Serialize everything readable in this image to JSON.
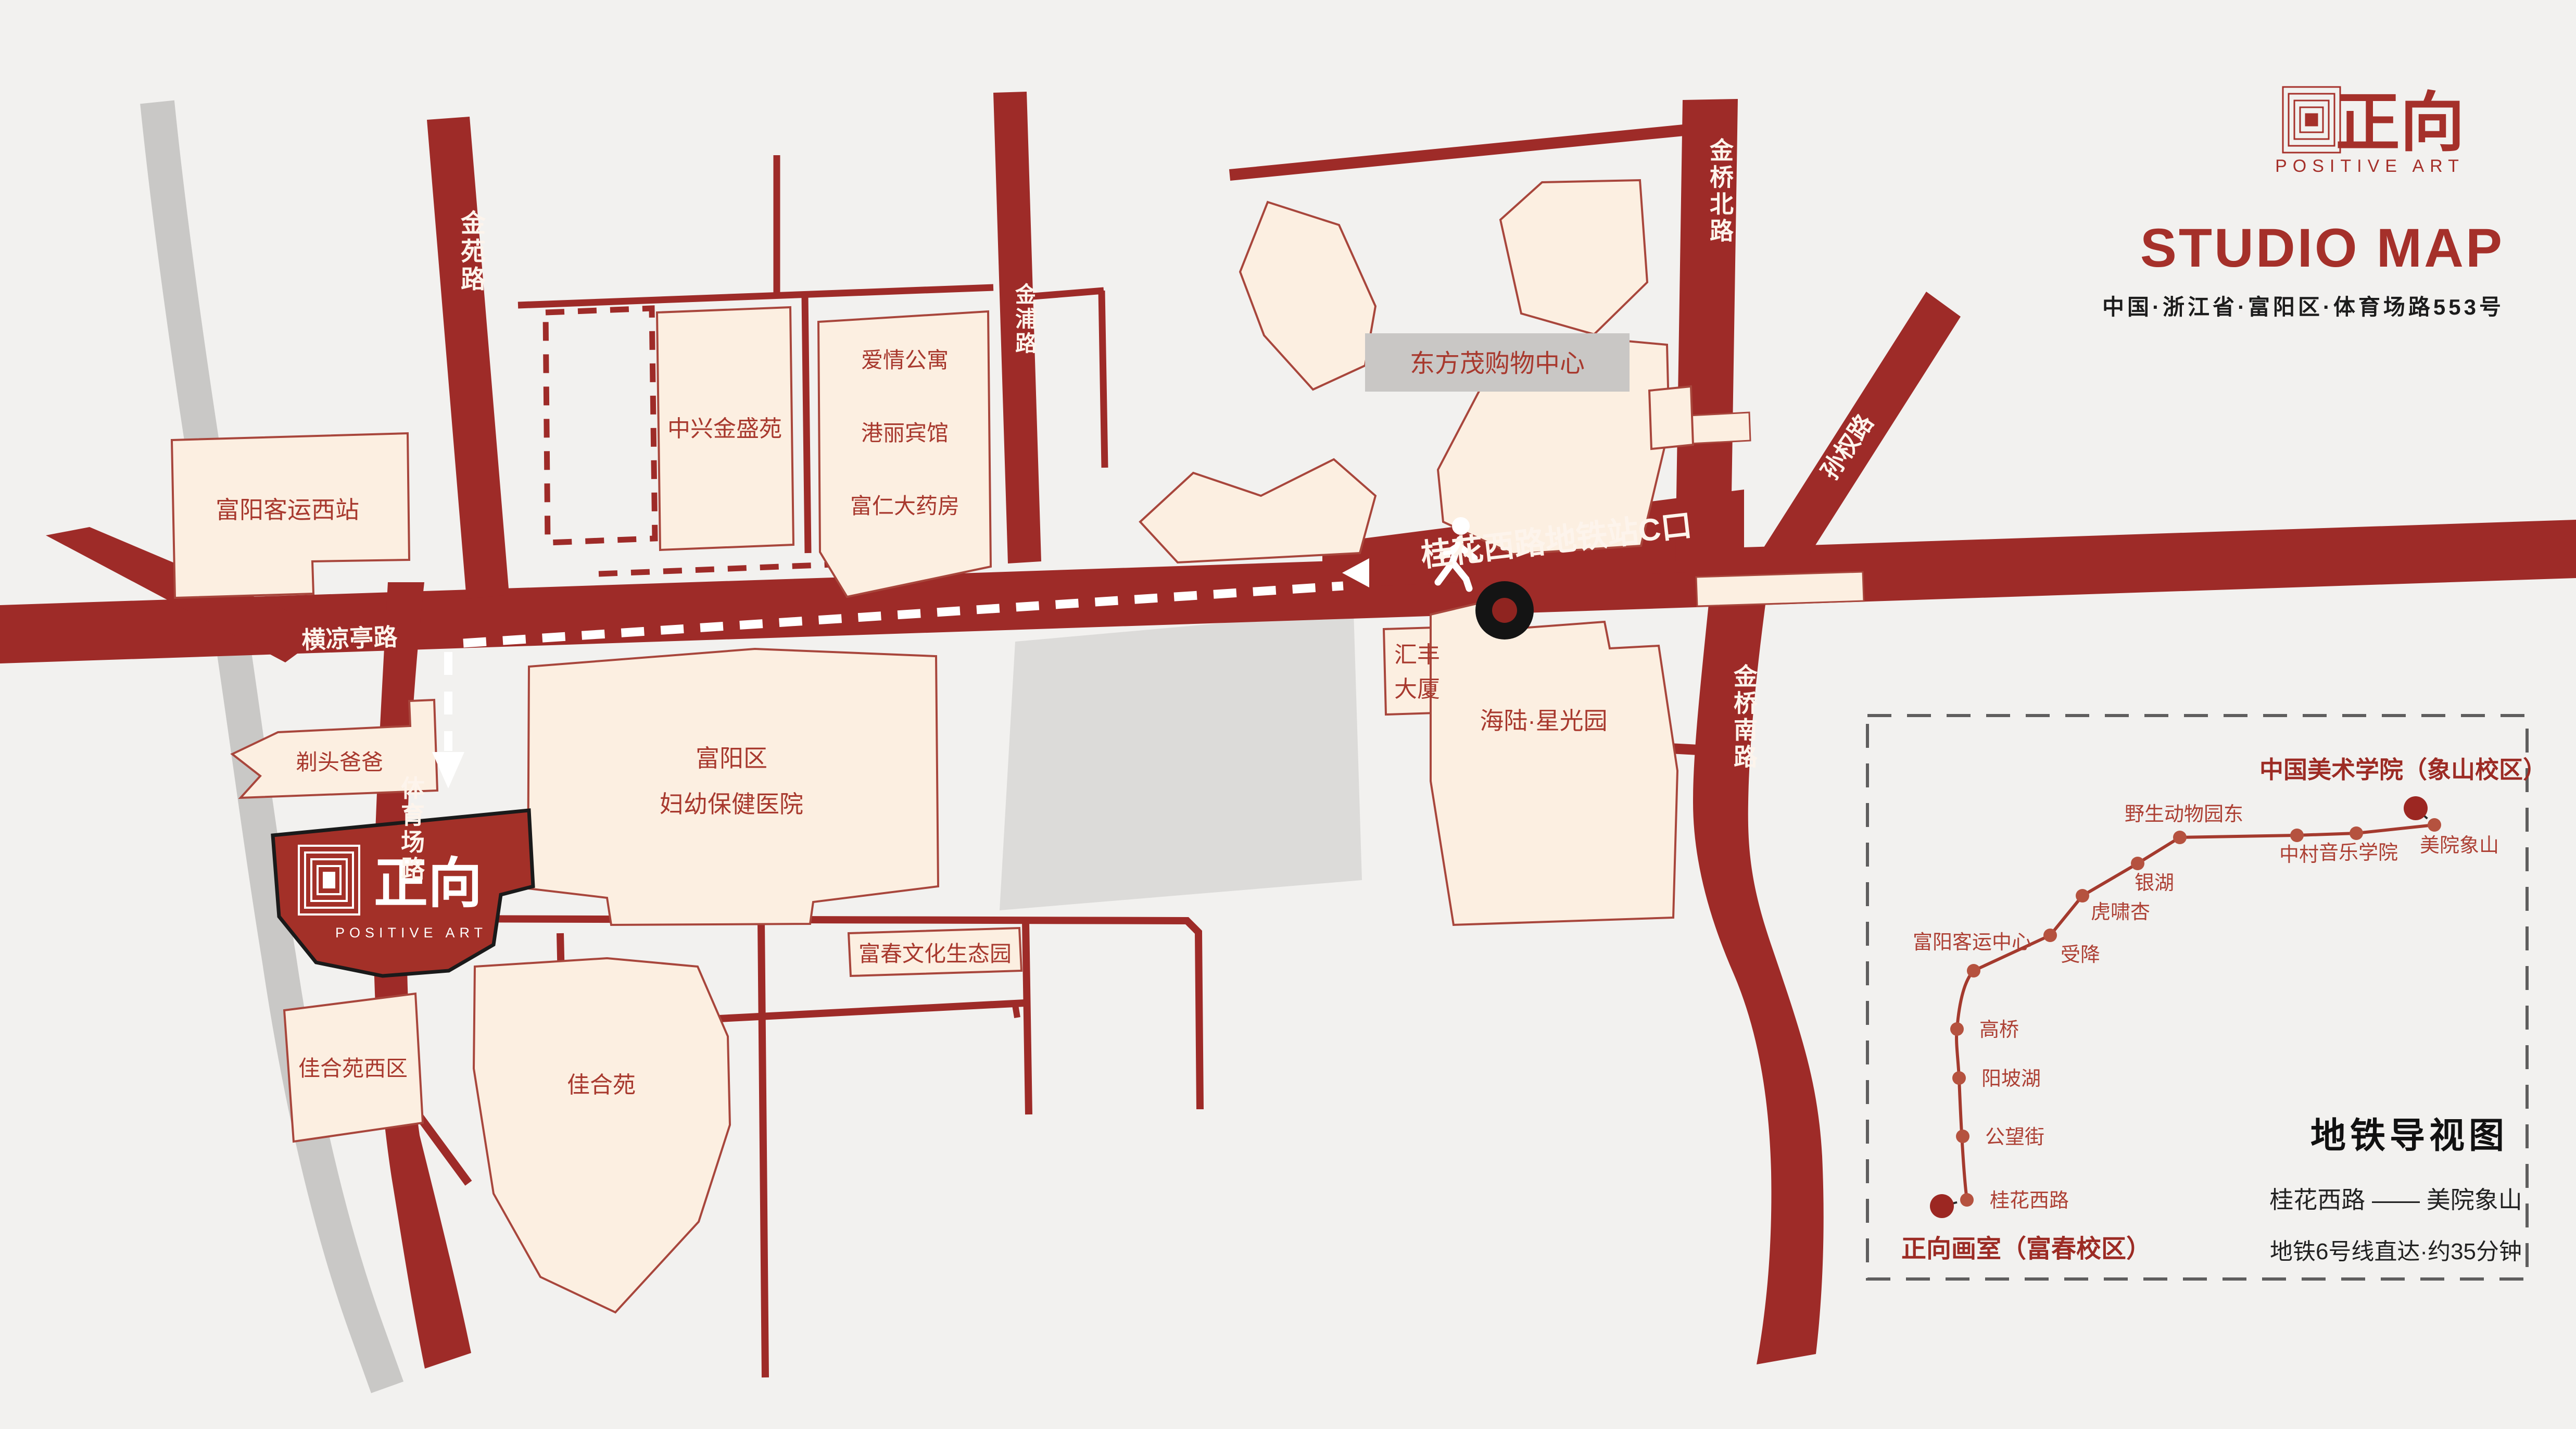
{
  "colors": {
    "road_red": "#9e2b28",
    "building_cream": "#fcefe1",
    "accent_red": "#a5302a",
    "gray_block": "#dcdbd9",
    "gray_road": "#c9c8c6",
    "ink": "#1c1c1c",
    "metro_line": "#a43a2e"
  },
  "header": {
    "logo_cn": "正向",
    "logo_en": "POSITIVE ART",
    "title": "STUDIO MAP",
    "address": "中国·浙江省·富阳区·体育场路553号"
  },
  "roads": {
    "jinyuan": "金苑路",
    "jinpu": "金浦路",
    "jinqiao_north": "金桥北路",
    "sunquan": "孙权路",
    "jinqiao_south": "金桥南路",
    "hengliangting": "横凉亭路",
    "tiyuchang": "体育场路"
  },
  "route": {
    "metro_exit": "桂花西路地铁站C口"
  },
  "buildings": {
    "fuyang_west_bus": "富阳客运西站",
    "zhongxing": "中兴金盛苑",
    "aiqing": "爱情公寓",
    "gangli": "港丽宾馆",
    "furen": "富仁大药房",
    "dongfangmao": "东方茂购物中心",
    "huifeng_1": "汇丰",
    "huifeng_2": "大厦",
    "hailu": "海陆·星光园",
    "hospital_1": "富阳区",
    "hospital_2": "妇幼保健医院",
    "titou": "剃头爸爸",
    "jiahe_west": "佳合苑西区",
    "jiahe": "佳合苑",
    "fuchun_park": "富春文化生态园"
  },
  "studio": {
    "cn": "正向",
    "en": "POSITIVE ART"
  },
  "panel": {
    "title": "地铁导视图",
    "route": "桂花西路 —— 美院象山",
    "note": "地铁6号线直达·约35分钟",
    "start": "正向画室（富春校区）",
    "end": "中国美术学院（象山校区）",
    "stations": [
      "桂花西路",
      "公望街",
      "阳坡湖",
      "高桥",
      "富阳客运中心",
      "受降",
      "虎啸杏",
      "银湖",
      "野生动物园东",
      "中村",
      "音乐学院",
      "美院象山"
    ]
  }
}
